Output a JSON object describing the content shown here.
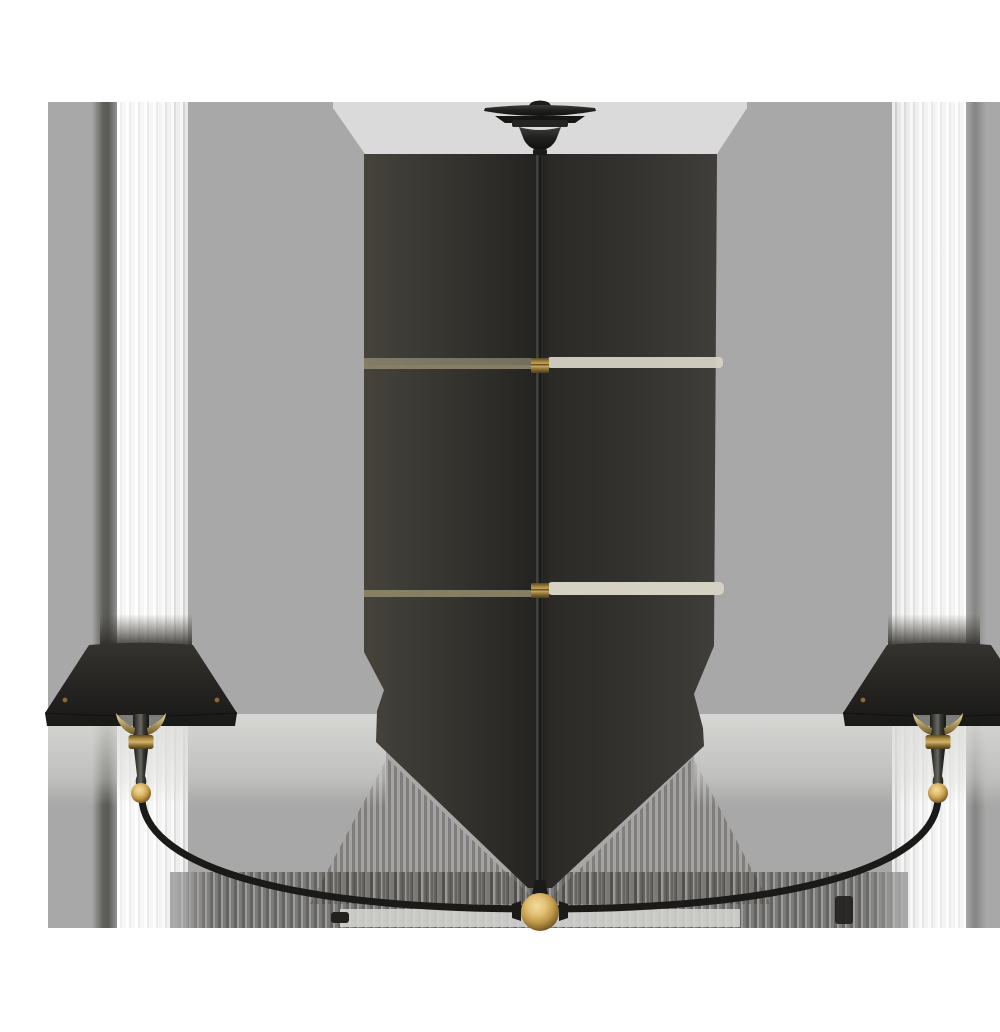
{
  "image": {
    "alt": "Product photograph of a large two-light linear chandelier: bronze finish with hand-rubbed antique brass accents, center downrod with brass couplings, brass ball finial, two sweeping curved arms ending in tapered candles under flared bronze shades, shown against a white and gray studio backdrop with soft shadow bands",
    "type": "product-photograph"
  },
  "colors": {
    "page-bg": "#ffffff",
    "backdrop": "#a8a8a8",
    "backdrop-light": "#dadada",
    "fixture-black": "#1d1d1b",
    "brass": "#b08f4c",
    "brass-bright": "#f0dd9e",
    "brass-deep": "#5c4820",
    "band-olive": "#8f8768",
    "band-beige": "#d5d1c3",
    "shadow-dark": "#34322c"
  },
  "parts": {
    "canopy": "ceiling-canopy",
    "downrod": "three-section-downrod",
    "couplings": "brass-stem-couplings",
    "finial": "brass-ball-finial",
    "arms": "curved-double-arm",
    "shades": "flared-bronze-shades",
    "candles": "tapered-candles-with-brass-details"
  }
}
